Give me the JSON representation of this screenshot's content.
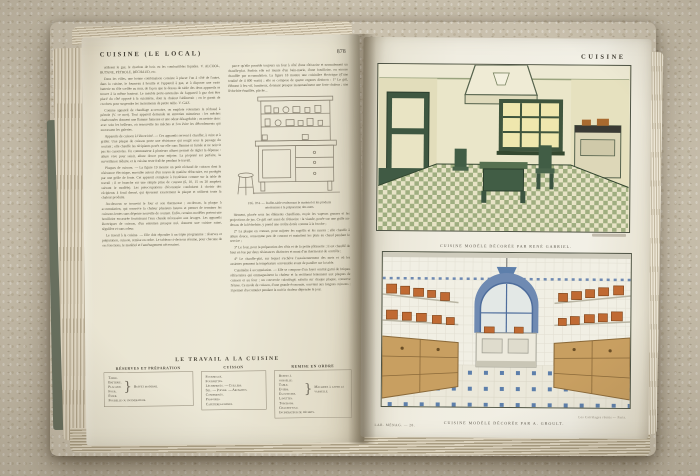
{
  "palette": {
    "carpet": "#c9c0ad",
    "page": "#ece8d7",
    "green_kitchen_accent": "#415d45",
    "blue_kitchen_accent": "#5d7fab",
    "copper_pots": "#c06a33",
    "wood_cabinet": "#c89f61"
  },
  "left_page": {
    "header": "CUISINE  (LE  LOCAL)",
    "page_number": "878",
    "col1": [
      "utilisent le gaz, le charbon de bois ou les combustibles liquides. V. ALCOOL, BUTANE, PÉTROLE, RÉCHAUD, etc.",
      "Dans les villes, une bonne combinaison consiste à placer l'un à côté de l'autre, dans la cuisine, le fourneau à houille et l'appareil à gaz, et à disposer une vaste batterie en tôle scellée au mur, de façon que le dessus de table des deux appareils se trouve à la même hauteur. Le meuble porte-ustensiles de l'appareil à gaz doit être placé du côté opposé à la cuisinière, dont la chaleur l'abîmerait ; on le garnit de crochets pour suspendre les instruments de petite taille. V. GAZ.",
      "Comme appareil de chauffage accessoire, on emploie volontiers le réchaud à pétrole (V. ce mot). Tout appareil demande un entretien minutieux : les mèches charbonnées donnent une flamme fumeuse et une odeur désagréable ; on nettoie donc avec soin les brûleurs, on renouvelle les mèches et l'on évite les débordements qui encrassent les galeries.",
      "Appareils de cuisson à l'électricité. — Ces appareils servent à chauffer, à cuire et à griller. Une plaque de cuisson porte une résistance qui rougit sous le passage du courant ; elle chauffe les récipients posés sur elle sans flamme ni fumée et ne noircit pas les casseroles. Un commutateur à plusieurs allures permet de régler la dépense : allure vive pour saisir, allure douce pour mijoter. La propreté est parfaite, la surveillance réduite, et la cuisine reste fraîche pendant le travail.",
      "Plaques de cuisson. — La figure 19 montre un petit réchaud de cuisson dont la résistance électrique, enroulée autour d'un noyau de matière réfractaire, est protégée par une grille de fonte. Cet appareil s'emploie à l'extérieur comme sur la table de travail ; il se branche sur une simple prise de courant (6, 10, 15 ou 20 ampères suivant le modèle). Les préoccupations d'économie conduisent à choisir des récipients à fond dressé, qui épousent exactement la plaque et utilisent toute la chaleur produite.",
      "Au-dessous se trouvent le four et son thermostat ; au-dessus, la plaque à accumulation, qui conserve la chaleur plusieurs heures et permet de terminer les cuissons lentes sans dépense nouvelle de courant. Enfin, certains modèles portent une bouilloire encastrée fournissant l'eau chaude nécessaire aux lavages. Les appareils électriques de cuisson, d'un entretien presque nul, donnent une cuisine saine, régulière et sans odeur.",
      "Le travail à la cuisine. — Elle doit répondre à un triple programme : réserves et préparation, cuisson, remise en ordre. Le tableau ci-dessous résume, pour chacune de ces fonctions, le matériel et l'aménagement nécessaires."
    ],
    "col2_top": "parce qu'elle possède toujours un four à côté d'une rôtissoire et normalement un chauffe-plat. Parfois elle est munie d'un bain-marie, d'une bouilloire, ou encore chauffée par accumulation. La figure 18 montre une cuisinière électrique (d'une totalité de 4 800 watts) ; elle se compose de quatre organes distincts : 1° Le gril, élément à feu vif, lumineux, donnant presque instantanément une forte chaleur ; une lèchefrite émaillée, placée...",
    "figure": {
      "caption_line1": "FIG. 874. — Buffet-table renfermant le matériel et les produits",
      "caption_line2": "nécessaires à la préparation des mets."
    },
    "col2": [
      "blement, placée sous les éléments chauffants, reçoit les vapeurs grasses et les projections de jus. Ce gril sert aussi de rôtissoire : la viande, posée sur une grille au-dessus de la lèchefrite, y prend une croûte dorée comme à la broche ;",
      "2° La plaque en creuset, pour mijoter les ragoûts et les sauces ; elle chauffe à allure douce, consomme peu de courant et maintient les plats au chaud pendant le service ;",
      "3° Le four, pour la préparation des rôtis et de la petite pâtisserie ; il est chauffé de haut en bas par deux résistances distinctes et muni d'un thermostat de contrôle ;",
      "4° Le chauffe-plat, sur lequel s'achève l'assaisonnement des mets et où les assiettes prennent la température convenable avant de paraître sur la table.",
      "Cuisinière à accumulation. — Elle se compose d'un foyer central garni de briques réfractaires qui emmagasinent la chaleur et la restituent lentement aux plaques de cuisson et au four ; un couvercle calorifugé, rabattu sur chaque plaque, conserve l'étuve. Ce mode de cuisson, d'une grande économie, convient aux longues cuissons ; il permet d'accumuler pendant la nuit la chaleur dépensée le jour."
    ],
    "worktable": {
      "title": "LE TRAVAIL A LA CUISINE",
      "brace": "}",
      "col1": {
        "header": "RÉSERVES ET PRÉPARATION",
        "items": [
          "Table.",
          "Batterie.",
          "Placard.",
          "Four.",
          "Évier."
        ],
        "note": "Buffet moderne.",
        "extra": "Poubelle ou incinérateur."
      },
      "col2": {
        "header": "CUISSON",
        "items": [
          "Fourneaux.",
          "Fournettes.",
          "Lèchefrites. — Cuillers.",
          "Sel. — Poivre. — Aromates.",
          "Condiments.",
          "Passoires.",
          "Cafetières-filtres."
        ]
      },
      "col3": {
        "header": "REMISE EN ORDRE",
        "items": [
          "Buffet à vaisselle.",
          "Table.",
          "Éviers.",
          "Égouttoirs.",
          "Lavettes.",
          "Torchons."
        ],
        "note": "Machines à laver la vaisselle.",
        "extra": "Chauffe-eau.",
        "extra2": "Incinérateur de déchets."
      }
    }
  },
  "right_page": {
    "header": "CUISINE",
    "top_caption": "CUISINE MODÈLE DÉCORÉE PAR RENÉ GABRIEL.",
    "bottom_caption": "CUISINE MODÈLE DÉCORÉE PAR A. GROULT.",
    "bottom_credit": "Les Carrelages réunis — Paris.",
    "signature": "LAR. MÉNAG. — 28."
  }
}
